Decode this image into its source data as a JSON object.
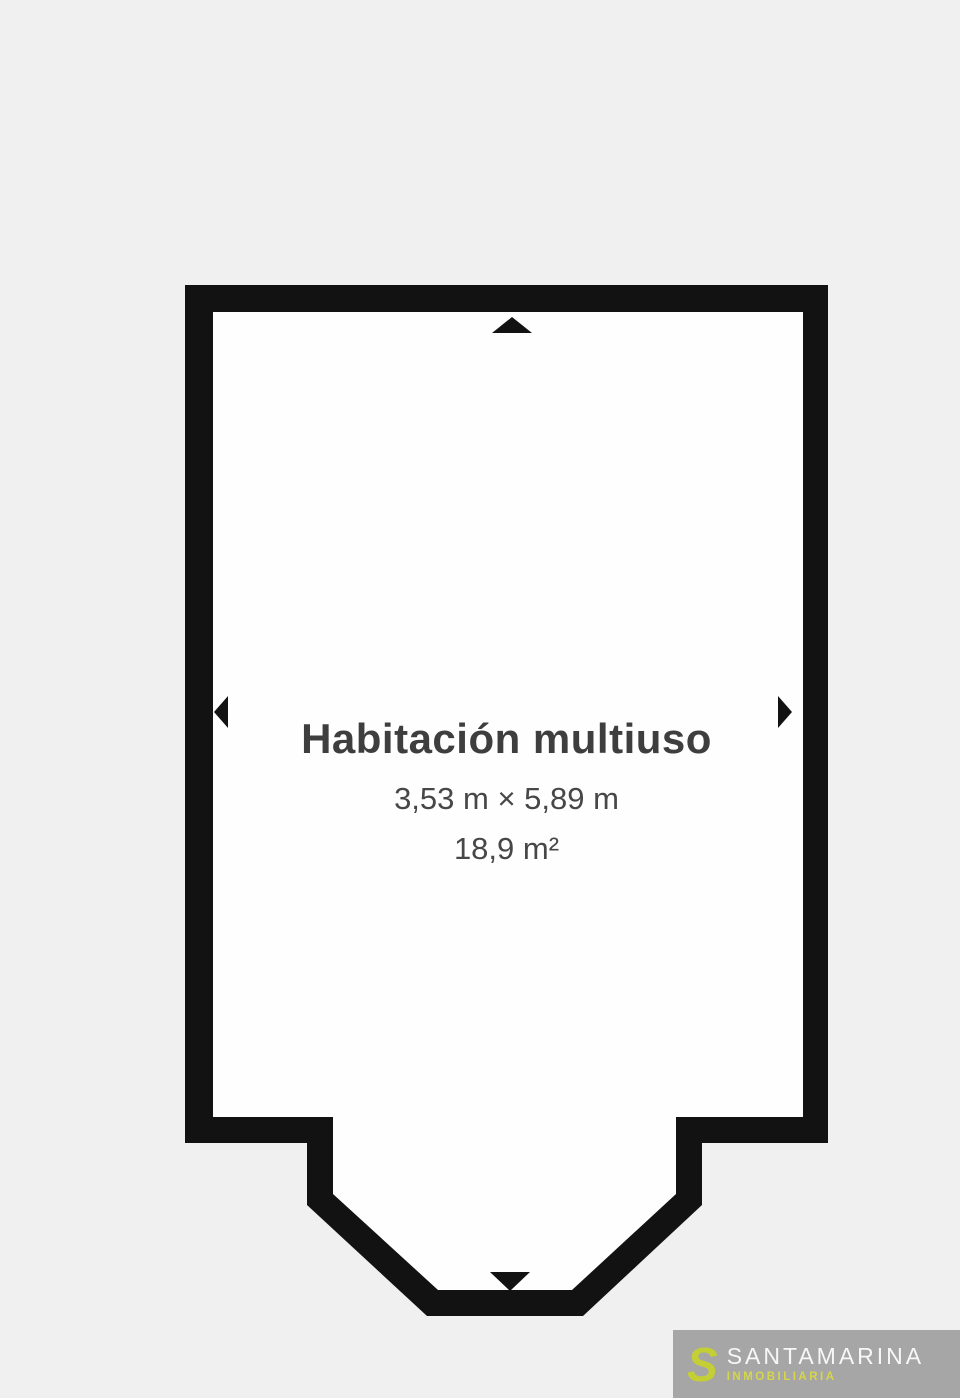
{
  "colors": {
    "page-bg": "#f1f0f0",
    "wall": "#121212",
    "room-fill": "#fefefe",
    "text": "#3e3e3e",
    "logo-bg": "#a6a6a6",
    "logo-accent": "#c3cf35",
    "logo-text": "#f7f7f7",
    "logo-tagline": "#d6d64b"
  },
  "floor_plan": {
    "room": {
      "name": "Habitación multiuso",
      "dimensions": "3,53 m × 5,89 m",
      "area": "18,9 m²"
    },
    "opening_markers": [
      {
        "icon": "arrow-up-icon",
        "wall": "top"
      },
      {
        "icon": "arrow-left-icon",
        "wall": "left"
      },
      {
        "icon": "arrow-right-icon",
        "wall": "right"
      },
      {
        "icon": "arrow-down-icon",
        "wall": "bottom"
      }
    ]
  },
  "watermark": {
    "logo_glyph": "S",
    "brand": "SANTAMARINA",
    "tagline": "INMOBILIARIA"
  }
}
